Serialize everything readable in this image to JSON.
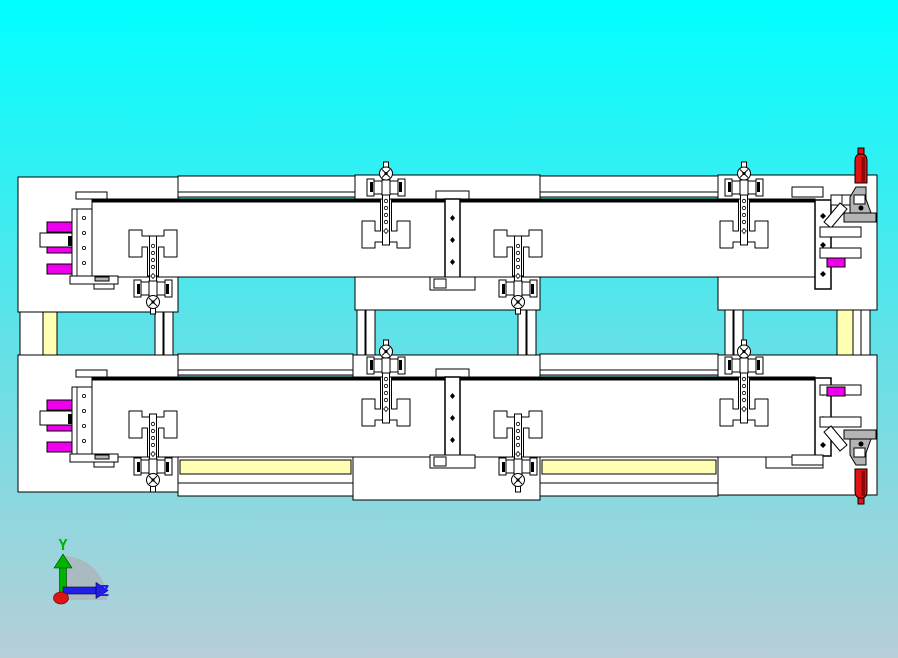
{
  "view": {
    "description": "CAD viewport front view of a twin-rail welding fixture assembly",
    "orientation": "front"
  },
  "triad": {
    "y_label": "Y",
    "z_label": "Z"
  },
  "colors": {
    "bg_top": "#00ffff",
    "bg_mid": "#5ee2e8",
    "bg_bottom": "#b7ced7",
    "part_fill": "#ffffff",
    "edge": "#000000",
    "pin_magenta": "#ee00ee",
    "strip_yellow": "#ffffb3",
    "pin_red": "#e01414",
    "pin_red_dark": "#8c0a0a",
    "clamp_gray": "#b4b4b4",
    "axis_y_green": "#00b400",
    "axis_z_blue": "#2020e8",
    "axis_x_red": "#dc1414",
    "triad_sector": "#a9bbc1"
  },
  "components": {
    "fixtures": [
      "upper-fixture",
      "lower-fixture"
    ],
    "per_fixture": {
      "main_beams": 2,
      "workpiece_cutouts": 4,
      "vertical_clamp_rods": 4,
      "magenta_locating_pins": 3,
      "toggle_clamp": 1,
      "red_handle_pin": 1
    },
    "support_leg_columns": 6,
    "yellow_spacer_strips": 4
  }
}
